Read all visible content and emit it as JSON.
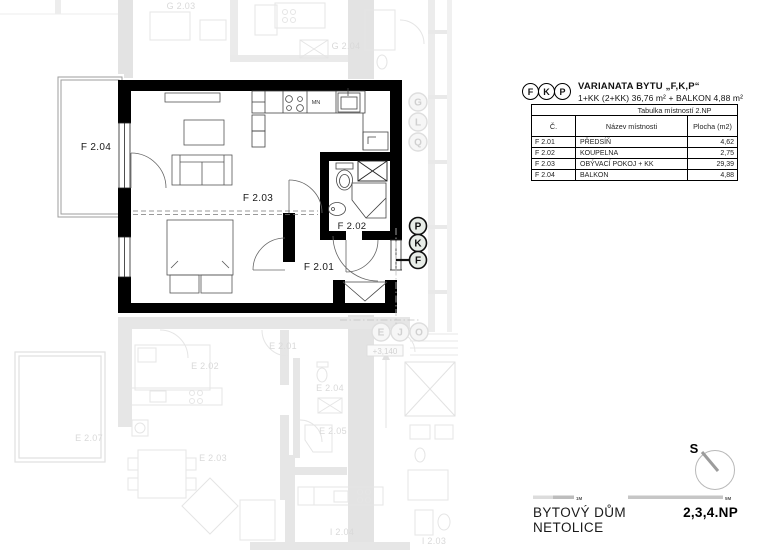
{
  "header": {
    "badges": [
      "F",
      "K",
      "P"
    ],
    "title": "VARIANATA BYTU „F,K,P“",
    "subtitle": "1+KK (2+KK) 36,76 m² + BALKON 4,88 m²"
  },
  "table": {
    "title": "Tabulka místností 2.NP",
    "columns": [
      "Č.",
      "Název místnosti",
      "Plocha (m2)"
    ],
    "rows": [
      {
        "code": "F 2.01",
        "name": "PŘEDSÍŇ",
        "area": "4,62"
      },
      {
        "code": "F 2.02",
        "name": "KOUPELNA",
        "area": "2,75"
      },
      {
        "code": "F 2.03",
        "name": "OBÝVACÍ POKOJ + KK",
        "area": "29,39"
      },
      {
        "code": "F 2.04",
        "name": "BALKON",
        "area": "4,88"
      }
    ]
  },
  "plan": {
    "room_labels": {
      "f201": "F 2.01",
      "f202": "F 2.02",
      "f203": "F 2.03",
      "f204": "F 2.04"
    },
    "kitchen_label": "MN",
    "variant_circles": [
      "P",
      "K",
      "F"
    ]
  },
  "background_plan": {
    "labels": {
      "g203": "G 2.03",
      "g204": "G 2.04",
      "e201": "E 2.01",
      "e202": "E 2.02",
      "e203": "E 2.03",
      "e204": "E 2.04",
      "e205": "E 2.05",
      "e207": "E 2.07",
      "i203": "I 2.03",
      "i204": "I 2.04"
    },
    "level_mark": "+3,140",
    "stack_letters": [
      "G",
      "L",
      "Q"
    ],
    "row_letters": [
      "E",
      "J",
      "O"
    ]
  },
  "footer": {
    "north_label": "S",
    "scale_small_label": "1M",
    "scale_large_label": "5M",
    "building_name": "BYTOVÝ DŮM NETOLICE",
    "floors_label": "2,3,4.NP"
  }
}
